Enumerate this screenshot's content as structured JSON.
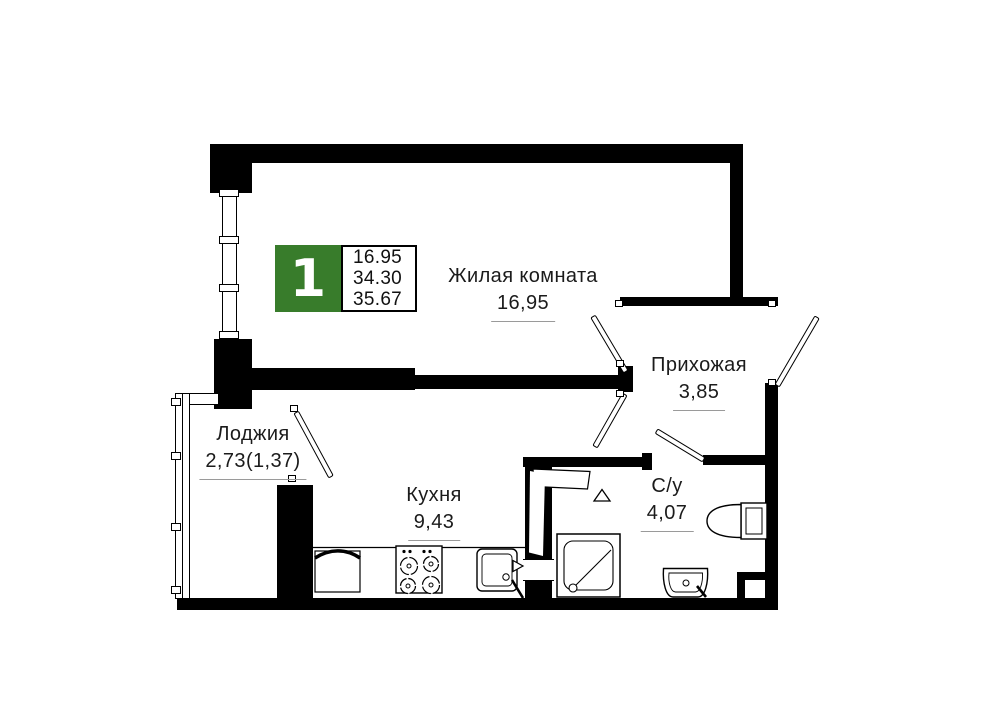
{
  "floorplan": {
    "badge": {
      "rooms_count": "1",
      "areas": [
        "16.95",
        "34.30",
        "35.67"
      ],
      "accent_green": "#387C2B"
    },
    "rooms": {
      "living": {
        "label": "Жилая комната",
        "area": "16,95"
      },
      "hallway": {
        "label": "Прихожая",
        "area": "3,85"
      },
      "loggia": {
        "label": "Лоджия",
        "area": "2,73(1,37)"
      },
      "kitchen": {
        "label": "Кухня",
        "area": "9,43"
      },
      "bathroom": {
        "label": "С/у",
        "area": "4,07"
      }
    },
    "fixtures": [
      "toilet",
      "shower-tray",
      "bathroom-sink",
      "kitchen-sink",
      "stove",
      "kitchen-cabinet",
      "sliding-door-leaf"
    ],
    "colors": {
      "walls": "#000000",
      "background": "#ffffff",
      "area_underline": "#9a9a9a"
    }
  }
}
